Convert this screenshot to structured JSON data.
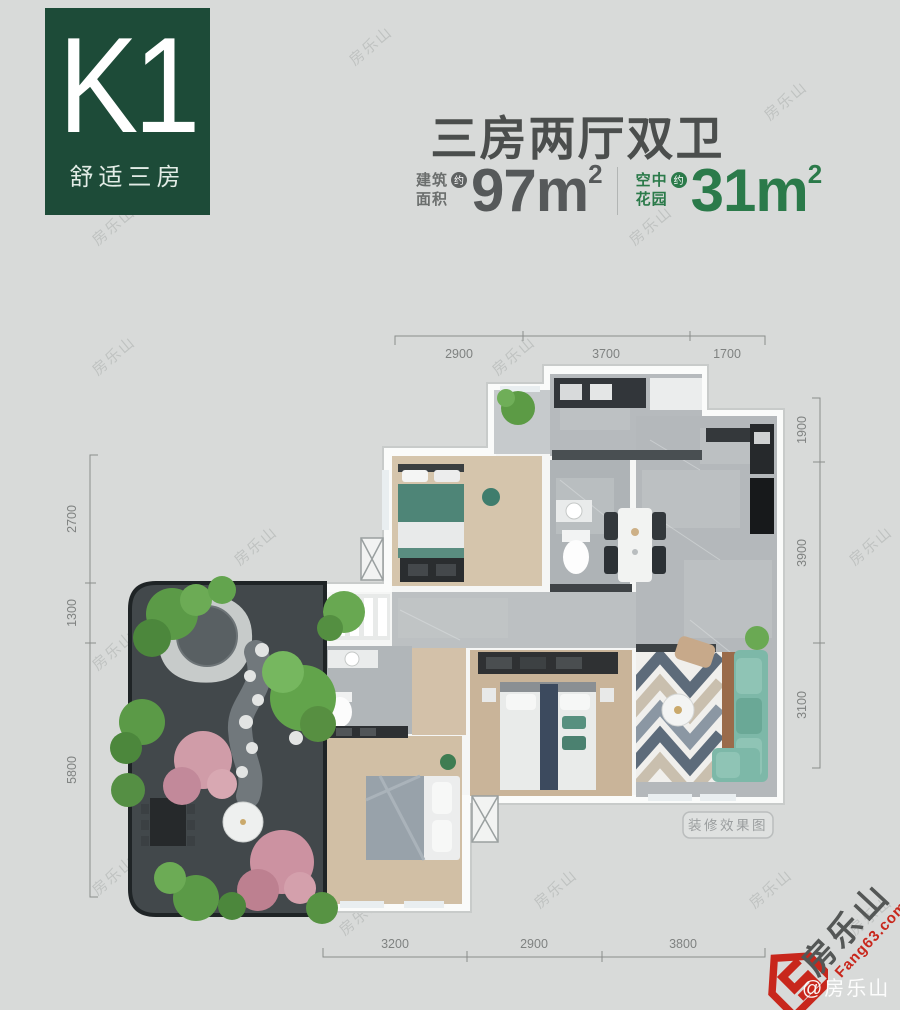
{
  "badge": {
    "code": "K1",
    "subtitle": "舒适三房"
  },
  "header": {
    "title": "三房两厅双卫",
    "areas": [
      {
        "label_l1": "建筑",
        "label_l2": "面积",
        "approx": "约",
        "num": "97",
        "unit": "m",
        "sup": "2"
      },
      {
        "label_l1": "空中",
        "label_l2": "花园",
        "approx": "约",
        "num": "31",
        "unit": "m",
        "sup": "2"
      }
    ]
  },
  "dims": {
    "top": [
      "2900",
      "3700",
      "1700"
    ],
    "right": [
      "1900",
      "3900",
      "3100"
    ],
    "left": [
      "2700",
      "1300",
      "5800"
    ],
    "bottom": [
      "3200",
      "2900",
      "3800"
    ]
  },
  "plan": {
    "render_label": "装修效果图"
  },
  "watermark": {
    "tile": "房乐山",
    "brand": "房乐山",
    "site": "Fang63.com",
    "handle": "@房乐山"
  },
  "colors": {
    "badge_green": "#1d4b38",
    "accent_green": "#2b7a4a",
    "logo_red": "#c8271c",
    "title_gray": "#4b4e4d",
    "background": "#d8dad9"
  }
}
